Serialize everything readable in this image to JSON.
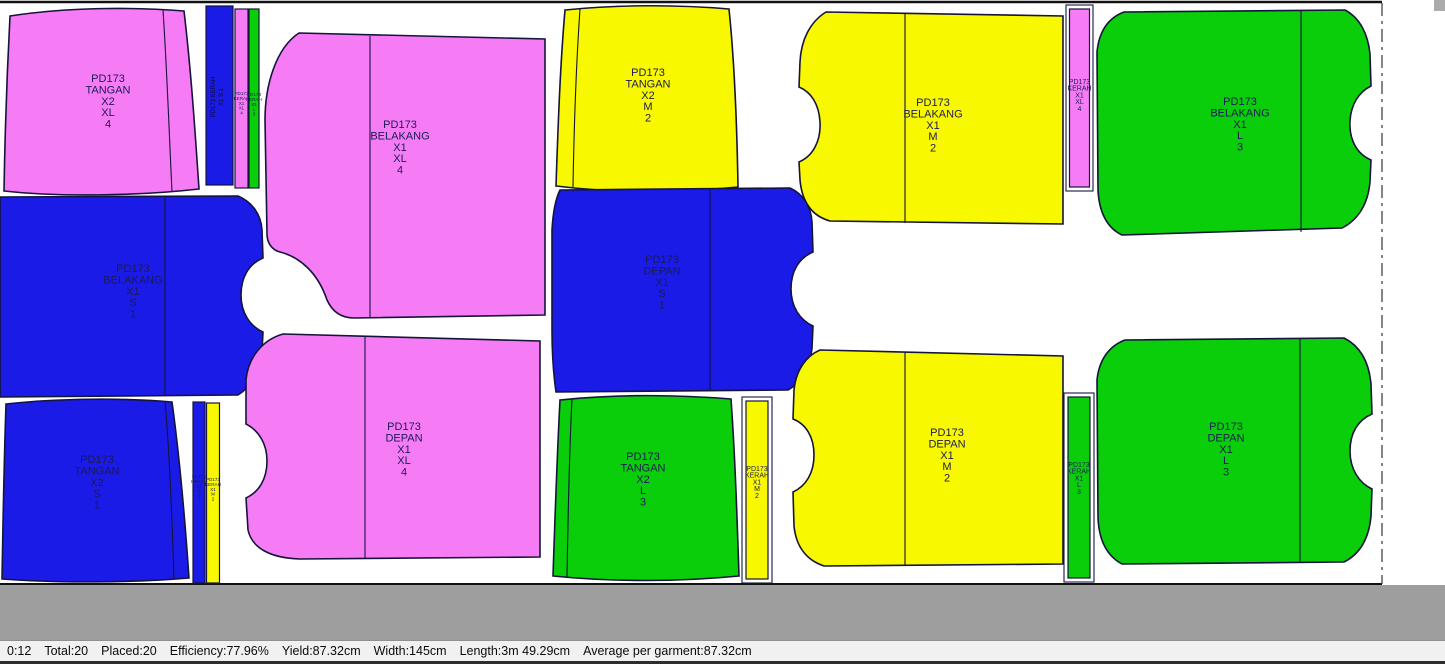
{
  "status_bar": {
    "time": "0:12",
    "total": "Total:20",
    "placed": "Placed:20",
    "efficiency": "Efficiency:77.96%",
    "yield": "Yield:87.32cm",
    "width": "Width:145cm",
    "length": "Length:3m 49.29cm",
    "average": "Average per garment:87.32cm"
  },
  "colors": {
    "size_s_blue": "#1b1be8",
    "size_m_yellow": "#f8f800",
    "size_l_green": "#0ace0a",
    "size_xl_pink": "#f67cf6",
    "outline": "#14143c",
    "offcut_gray": "#9e9e9e"
  },
  "pieces": [
    {
      "style": "PD173",
      "part": "TANGAN",
      "mult": "X2",
      "size": "XL",
      "num": "4",
      "color": "#f67cf6"
    },
    {
      "style": "PD173",
      "part": "KERAH",
      "mult": "X1",
      "size": "S",
      "num": "1",
      "color": "#1b1be8"
    },
    {
      "style": "PD173",
      "part": "KERAH",
      "mult": "X1",
      "size": "XL",
      "num": "4",
      "color": "#f67cf6"
    },
    {
      "style": "PD173",
      "part": "KERAH",
      "mult": "X1",
      "size": "L",
      "num": "3",
      "color": "#0ace0a"
    },
    {
      "style": "PD173",
      "part": "BELAKANG",
      "mult": "X1",
      "size": "XL",
      "num": "4",
      "color": "#f67cf6"
    },
    {
      "style": "PD173",
      "part": "TANGAN",
      "mult": "X2",
      "size": "M",
      "num": "2",
      "color": "#f8f800"
    },
    {
      "style": "PD173",
      "part": "BELAKANG",
      "mult": "X1",
      "size": "M",
      "num": "2",
      "color": "#f8f800"
    },
    {
      "style": "PD173",
      "part": "KERAH",
      "mult": "X1",
      "size": "XL",
      "num": "4",
      "color": "#f67cf6"
    },
    {
      "style": "PD173",
      "part": "BELAKANG",
      "mult": "X1",
      "size": "L",
      "num": "3",
      "color": "#0ace0a"
    },
    {
      "style": "PD173",
      "part": "BELAKANG",
      "mult": "X1",
      "size": "S",
      "num": "1",
      "color": "#1b1be8"
    },
    {
      "style": "PD173",
      "part": "DEPAN",
      "mult": "X1",
      "size": "S",
      "num": "1",
      "color": "#1b1be8"
    },
    {
      "style": "PD173",
      "part": "TANGAN",
      "mult": "X2",
      "size": "S",
      "num": "1",
      "color": "#1b1be8"
    },
    {
      "style": "PD173",
      "part": "KERAH",
      "mult": "X1",
      "size": "S",
      "num": "1",
      "color": "#1b1be8"
    },
    {
      "style": "PD173",
      "part": "KERAH",
      "mult": "X1",
      "size": "M",
      "num": "2",
      "color": "#f8f800"
    },
    {
      "style": "PD173",
      "part": "DEPAN",
      "mult": "X1",
      "size": "XL",
      "num": "4",
      "color": "#f67cf6"
    },
    {
      "style": "PD173",
      "part": "TANGAN",
      "mult": "X2",
      "size": "L",
      "num": "3",
      "color": "#0ace0a"
    },
    {
      "style": "PD173",
      "part": "KERAH",
      "mult": "X1",
      "size": "M",
      "num": "2",
      "color": "#f8f800"
    },
    {
      "style": "PD173",
      "part": "DEPAN",
      "mult": "X1",
      "size": "M",
      "num": "2",
      "color": "#f8f800"
    },
    {
      "style": "PD173",
      "part": "KERAH",
      "mult": "X1",
      "size": "L",
      "num": "3",
      "color": "#0ace0a"
    },
    {
      "style": "PD173",
      "part": "DEPAN",
      "mult": "X1",
      "size": "L",
      "num": "3",
      "color": "#0ace0a"
    }
  ]
}
